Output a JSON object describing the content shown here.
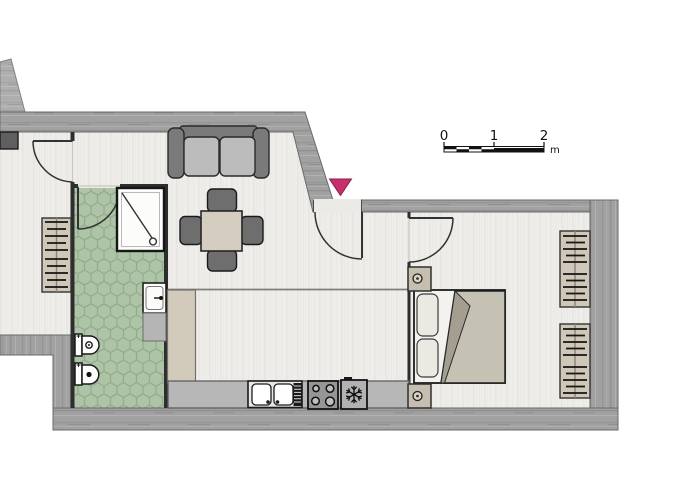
{
  "page": {
    "type": "apartment-floor-plan",
    "background": "#ffffff"
  },
  "scale_bar": {
    "labels": [
      "0",
      "1",
      "2"
    ],
    "unit": "m"
  },
  "entrance": {
    "marker": "entrance-triangle-icon",
    "color": "#c72f6d"
  },
  "palette": {
    "wall_gray": "#a1a1a1",
    "floor": "#efede9",
    "bathroom_tile_green": "#adc4a6",
    "counter_gray": "#b7b7b7",
    "furniture_tan": "#d5cec0",
    "dark_furniture": "#6e6e6e",
    "outline": "#1f1f1f",
    "accent_pink": "#c72f6d"
  },
  "symbols": {
    "living_area": [
      "sofa",
      "dining-table",
      "four-chairs",
      "tall-cabinet",
      "kitchen-counter",
      "double-sink",
      "drainer-hatch",
      "cooktop-4-burners",
      "freezer-snowflake-icon"
    ],
    "bathroom": [
      "hex-tile-floor",
      "shower",
      "shower-drain",
      "washbasin",
      "vanity-cabinet",
      "bidet",
      "toilet",
      "door"
    ],
    "bedroom": [
      "double-bed",
      "two-pillows",
      "folded-blanket",
      "radiator",
      "radiator",
      "wall-pier-with-hinge",
      "door"
    ],
    "side_room": [
      "radiator",
      "door",
      "cut-off-counter"
    ],
    "doors_count": 4,
    "radiators_count": 3
  }
}
